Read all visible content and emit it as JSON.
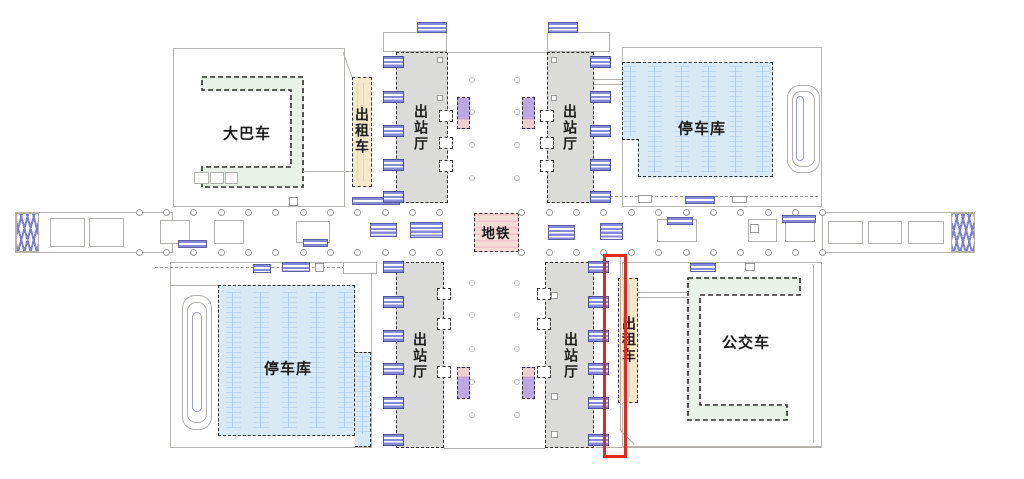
{
  "plan": {
    "type": "station-floor-plan",
    "areas": [
      {
        "id": "coach",
        "label": "大巴车",
        "fill": "#e9f2e8"
      },
      {
        "id": "taxi-top",
        "label": "出租车",
        "fill": "#f4e9ca"
      },
      {
        "id": "exit-hall-top-left",
        "label": "出站厅",
        "fill": "#dbdbd9"
      },
      {
        "id": "exit-hall-top-right",
        "label": "出站厅",
        "fill": "#dbdbd9"
      },
      {
        "id": "parking-top-right",
        "label": "停车库",
        "fill": "#d9eaf7"
      },
      {
        "id": "metro",
        "label": "地铁",
        "fill": "#f6d9d6"
      },
      {
        "id": "parking-bottom-left",
        "label": "停车库",
        "fill": "#d9eaf7"
      },
      {
        "id": "exit-hall-bottom-left",
        "label": "出站厅",
        "fill": "#dbdbd9"
      },
      {
        "id": "exit-hall-bottom-right",
        "label": "出站厅",
        "fill": "#dbdbd9"
      },
      {
        "id": "taxi-bottom",
        "label": "出租车",
        "fill": "#f4e9ca",
        "highlighted": true
      },
      {
        "id": "bus",
        "label": "公交车",
        "fill": "#e9f2e8"
      }
    ],
    "highlight_color": "#e3281f",
    "accent_purple": "#7d80d2",
    "dashed_boundary_color": "#2e2c2a"
  }
}
